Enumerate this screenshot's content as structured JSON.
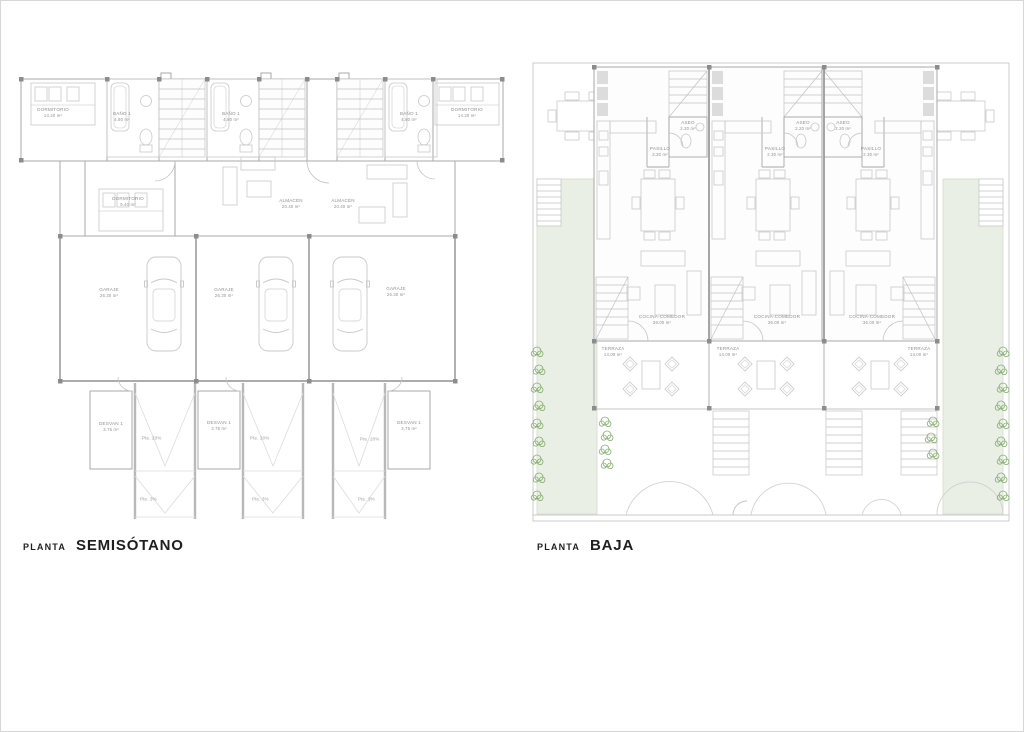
{
  "page": {
    "background": "#ffffff",
    "border_color": "#d6d6d6",
    "description": "Two architectural floor plans of three attached townhouses"
  },
  "colors": {
    "garden-green": "#e9efe5",
    "vegetation-green": "#74a059",
    "wall-gray": "#a8a8a8",
    "label-gray": "#8f8f8f",
    "title-black": "#1f1f1f"
  },
  "plans": {
    "semisotano": {
      "title_prefix": "PLANTA",
      "title": "SEMISÓTANO",
      "rooms": [
        {
          "id": "dormitorio-izq",
          "label": "DORMITORIO",
          "area": "14.20 m²"
        },
        {
          "id": "bano1-unidad1",
          "label": "BAÑO 1",
          "area": "4.80 m²"
        },
        {
          "id": "bano1-unidad2",
          "label": "BAÑO 1",
          "area": "4.80 m²"
        },
        {
          "id": "bano1-unidad3",
          "label": "BAÑO 1",
          "area": "4.80 m²"
        },
        {
          "id": "dormitorio-der",
          "label": "DORMITORIO",
          "area": "14.20 m²"
        },
        {
          "id": "dormitorio-2",
          "label": "DORMITORIO",
          "area": "9.40 m²"
        },
        {
          "id": "almacen-1",
          "label": "ALMACÉN",
          "area": "20.40 m²"
        },
        {
          "id": "almacen-2",
          "label": "ALMACÉN",
          "area": "20.40 m²"
        },
        {
          "id": "garaje-1",
          "label": "GARAJE",
          "area": "26.30 m²"
        },
        {
          "id": "garaje-2",
          "label": "GARAJE",
          "area": "26.30 m²"
        },
        {
          "id": "garaje-3",
          "label": "GARAJE",
          "area": "26.30 m²"
        },
        {
          "id": "desvan-1",
          "label": "DESVAN 1",
          "area": "3.75 m²"
        },
        {
          "id": "desvan-2",
          "label": "DESVAN 1",
          "area": "3.75 m²"
        },
        {
          "id": "desvan-3",
          "label": "DESVAN 1",
          "area": "3.75 m²"
        }
      ],
      "ramp": {
        "upper": "Pte. 20%",
        "lower": "Pte. 3%"
      }
    },
    "baja": {
      "title_prefix": "PLANTA",
      "title": "BAJA",
      "rooms": [
        {
          "id": "aseo-1",
          "label": "ASEO",
          "area": "2.20 m²"
        },
        {
          "id": "aseo-2",
          "label": "ASEO",
          "area": "2.20 m²"
        },
        {
          "id": "aseo-3",
          "label": "ASEO",
          "area": "2.20 m²"
        },
        {
          "id": "pasillo-1",
          "label": "PASILLO",
          "area": "2.30 m²"
        },
        {
          "id": "pasillo-2",
          "label": "PASILLO",
          "area": "2.30 m²"
        },
        {
          "id": "pasillo-3",
          "label": "PASILLO",
          "area": "2.30 m²"
        },
        {
          "id": "cocina-comedor-1",
          "label": "COCINA-COMEDOR",
          "area": "36.00 m²"
        },
        {
          "id": "cocina-comedor-2",
          "label": "COCINA-COMEDOR",
          "area": "36.00 m²"
        },
        {
          "id": "cocina-comedor-3",
          "label": "COCINA-COMEDOR",
          "area": "36.00 m²"
        },
        {
          "id": "terraza-1",
          "label": "TERRAZA",
          "area": "14.00 m²"
        },
        {
          "id": "terraza-2",
          "label": "TERRAZA",
          "area": "14.00 m²"
        },
        {
          "id": "terraza-3",
          "label": "TERRAZA",
          "area": "14.00 m²"
        }
      ]
    }
  }
}
